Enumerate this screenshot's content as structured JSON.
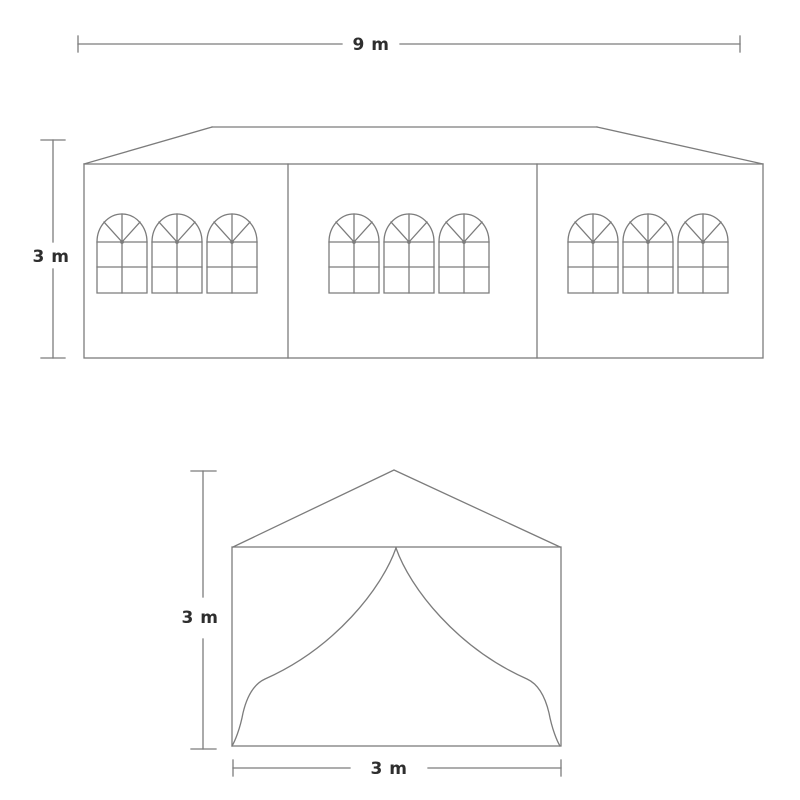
{
  "diagram": {
    "type": "tent-dimension-drawing",
    "background_color": "#ffffff",
    "line_color": "#7c7c7c",
    "text_color": "#2e2e2e",
    "side_view": {
      "width_label": "9 m",
      "height_label": "3 m",
      "panel_count": 3,
      "windows_per_panel": 3
    },
    "front_view": {
      "height_label": "3 m",
      "width_label": "3 m"
    }
  }
}
